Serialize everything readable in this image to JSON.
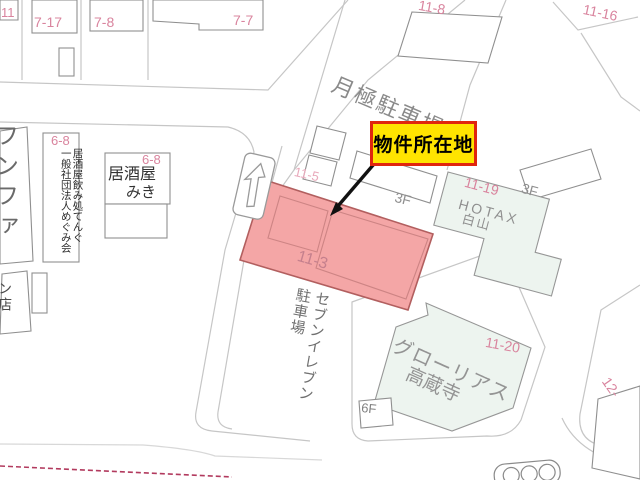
{
  "callout": {
    "label": "物件所在地"
  },
  "labels": {
    "lot11": "11",
    "lot717": "7-17",
    "lot78": "7-8",
    "lot77": "7-7",
    "lot118": "11-8",
    "lot1116": "11-16",
    "lot115": "11-5",
    "lot113": "11-3",
    "lot1119": "11-19",
    "lot1120": "11-20",
    "lot68a": "6-8",
    "lot68b": "6-8",
    "lot12": "12-",
    "floor3a": "3F",
    "floor3b": "3F",
    "floor6": "6F"
  },
  "places": {
    "monthly_parking": "月極駐車場",
    "hotax": "HOTAX",
    "hakusan": "白山",
    "izakaya_line1": "居酒屋",
    "izakaya_line2": "みき",
    "tenant_columns": "居酒屋飲み処てんぐ\n一般社団法人めぐみ会",
    "funfa": "フンファ",
    "n_ten": "ン店",
    "seven_eleven_parking": "セブンイレブン\n駐車場",
    "glorias": "グローリアス",
    "kozoji": "高蔵寺"
  },
  "colors": {
    "highlight_fill": "#f4a6a6",
    "highlight_border": "#b25f5f",
    "callout_fill": "#ffe400",
    "callout_border": "#e0260e",
    "parcel_label_pink": "#d9849e",
    "green_building_fill": "#edf4ef",
    "map_line_gray": "#c6c6c6",
    "building_outline_gray": "#8f8f8f",
    "dashed_boundary": "#b23a5e"
  }
}
